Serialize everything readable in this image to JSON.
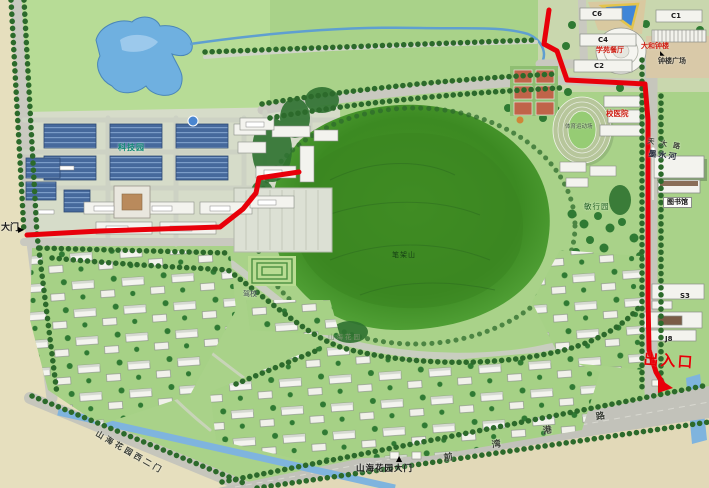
{
  "labels": {
    "gate_west": "大门",
    "tech_park": "科技园",
    "c6": "C6",
    "c4": "C4",
    "c2": "C2",
    "c1": "C1",
    "canteen": "学苑餐厅",
    "bell_tower": "大和钟楼",
    "bell_plaza": "钟楼广场",
    "hospital": "校医院",
    "stadium": "体育运动场",
    "library": "图书馆",
    "s3": "S3",
    "j8": "J8",
    "exit_gate": "出入口",
    "moshui_river": "墨水河",
    "road_tianda": "天大路",
    "minxing_garden": "敏行园",
    "bijia_hill": "笔架山",
    "shanhai_garden": "山海花园",
    "driving_school": "驾校",
    "west_gate2": "山海花园西二门",
    "main_gate": "山海花园大门",
    "road_qwg": [
      "前",
      "湾",
      "港",
      "路"
    ]
  },
  "icons": {
    "gate_marker_right": "▶",
    "gate_marker_up": "▲",
    "belltower_marker": "◣"
  },
  "colors": {
    "route": "#e8000a",
    "water": "#6fb0e0",
    "lawn": "#a9d289"
  }
}
